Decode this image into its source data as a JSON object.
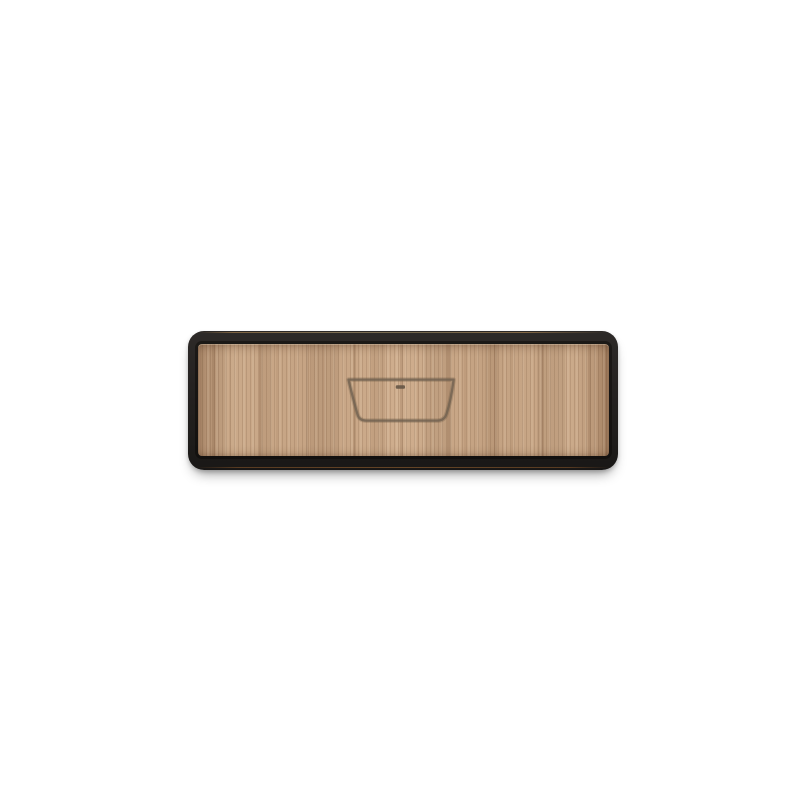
{
  "image": {
    "description": "3D render of a rectangular wooden plaque (drawer-front style) with a dark charcoal rounded frame and a light oak vertical-grain veneer panel, centered on a white background",
    "background_color": "#ffffff"
  },
  "plaque": {
    "frame_color": "#242120",
    "frame_top_highlight_color": "#d8a35f",
    "frame_bottom_edge_color": "#96622f",
    "wood_base_color": "#c9a787",
    "wood_streak_dark_color": "#a5805f",
    "wood_streak_light_color": "#dcc0a0",
    "outer_corner_radius_px": 16,
    "panel_corner_radius_px": 4
  },
  "icon": {
    "name": "bathtub-icon",
    "style": "engraved outline of a freestanding bathtub, wide rim tapering to a narrower flat base, small overflow-drain slot near the top center",
    "outline_color": "#6f6050",
    "outline_soft_color": "rgba(104, 86, 66, 0.28)",
    "drain_color": "#5f5142"
  }
}
